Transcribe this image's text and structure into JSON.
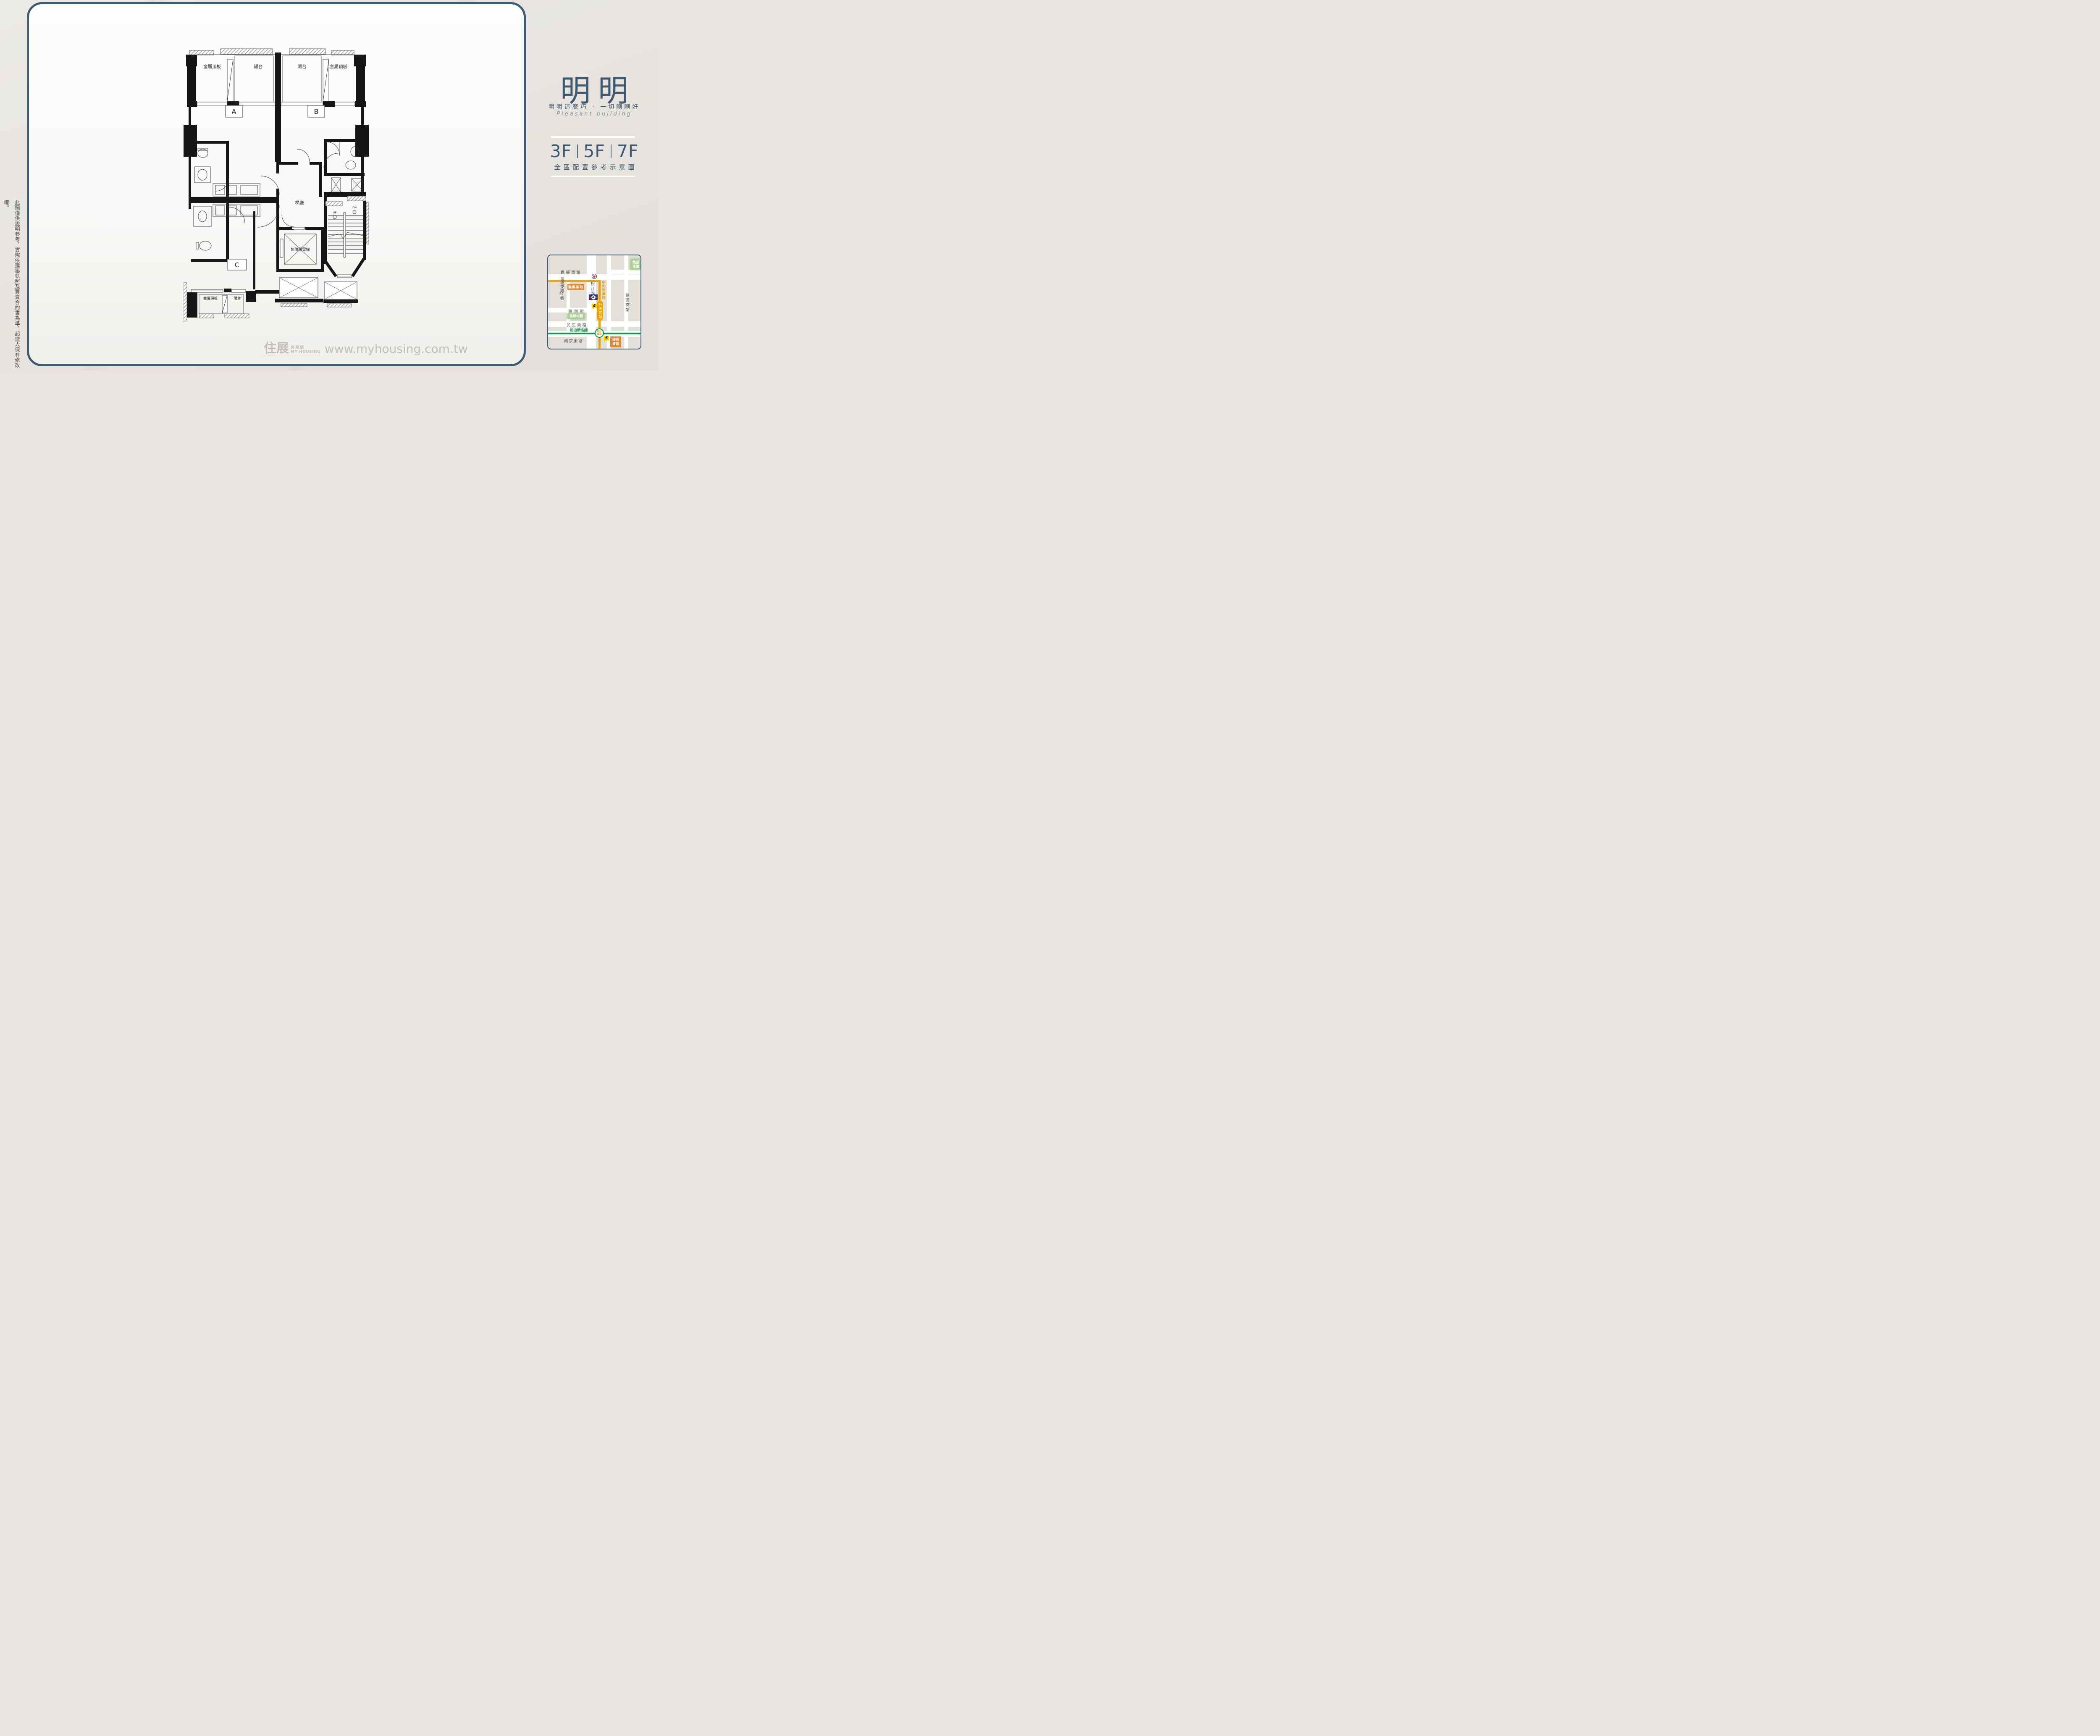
{
  "brand": {
    "title": "明明",
    "tagline": "明明這麼巧 · 一切剛剛好",
    "subtitle_en": "Pleasant building"
  },
  "floors": {
    "f1": "3F",
    "f2": "5F",
    "f3": "7F",
    "caption": "全區配置參考示意圖"
  },
  "disclaimer": {
    "text": "此圖僅供說明參考，實際依建築執照及買賣合約書為準，起造人保有修改權。"
  },
  "plan": {
    "labels": {
      "metal_top_left": "金屬頂板",
      "balcony_a": "陽台",
      "balcony_b": "陽台",
      "metal_top_right": "金屬頂板",
      "unit_a": "A",
      "unit_b": "B",
      "unit_c": "C",
      "stair_hall": "梯廳",
      "elevator": "無障礙電梯",
      "up": "UP",
      "dn": "DN",
      "metal_bottom": "金屬頂板",
      "balcony_c": "陽台"
    }
  },
  "map": {
    "roads": {
      "minquan_e": "民權東路",
      "minquan_lane_pre": "民權東路",
      "minquan_lane_num": "92",
      "minquan_lane_post": "巷",
      "jinzhou": "錦洲街",
      "minsheng_e": "民生東路",
      "nanjing_e": "南京東路",
      "songjiang": "松江路",
      "jianguo_elevated": "建國高架"
    },
    "transit": {
      "zhonghe_xinlu_line": "中和新蘆線",
      "songshan_xindian_line": "松山新店線",
      "xingtian_temple_station": "行天宮站",
      "songjiang_nanjing_l1": "松江",
      "songjiang_nanjing_l2": "南京",
      "exit4": "4",
      "exit5": "5"
    },
    "places": {
      "site": "建築基地",
      "songjin_park": "松錦公園",
      "rongxing_l1": "榮星",
      "rongxing_l2": "花園",
      "reception_l1": "接待",
      "reception_l2": "會館",
      "post": "郵",
      "bank_mark": "A"
    },
    "colors": {
      "metro_orange": "#F0A202",
      "metro_green": "#009B48"
    }
  },
  "watermark": {
    "logo_cn": "住展",
    "logo_sub": "房屋網",
    "logo_en": "MY HOUSING",
    "url": "www.myhousing.com.tw"
  }
}
